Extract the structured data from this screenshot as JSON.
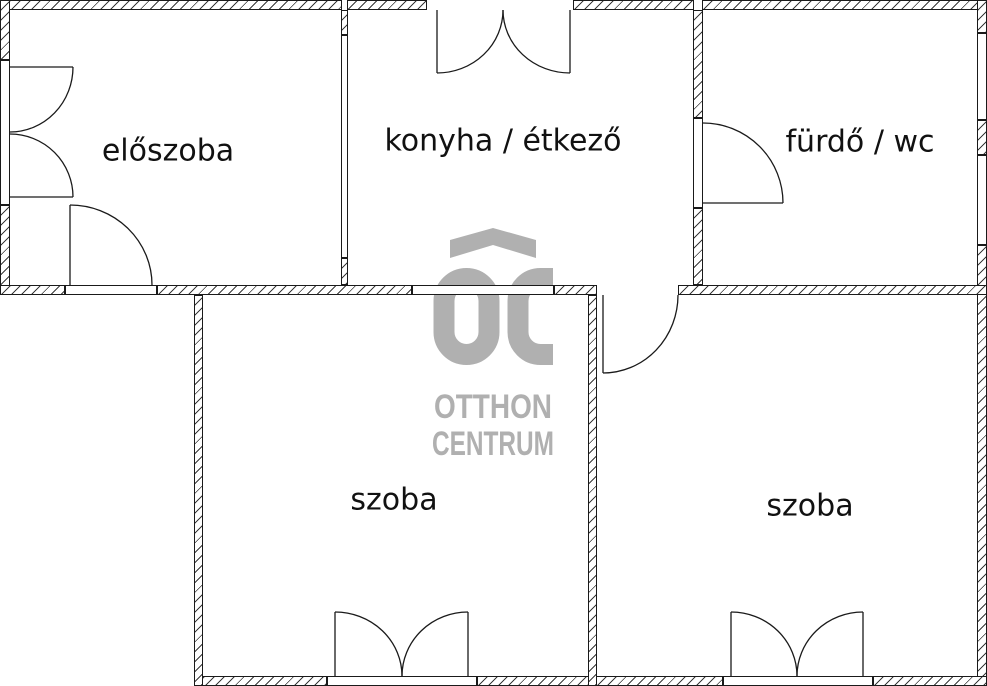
{
  "canvas": {
    "width": 987,
    "height": 686
  },
  "colors": {
    "background": "#ffffff",
    "wall_outline": "#1a1a1a",
    "hatch_line": "#3a3a3a",
    "watermark_grey": "#b0b0b0",
    "label_text": "#111111"
  },
  "rooms": [
    {
      "key": "eloszoba",
      "label": "előszoba"
    },
    {
      "key": "konyha-etkezo",
      "label": "konyha / étkező"
    },
    {
      "key": "furdo-wc",
      "label": "fürdő / wc"
    },
    {
      "key": "szoba-bal",
      "label": "szoba"
    },
    {
      "key": "szoba-jobb",
      "label": "szoba"
    }
  ],
  "watermark": {
    "monogram": "OC",
    "line1": "OTTHON",
    "line2": "CENTRUM"
  }
}
